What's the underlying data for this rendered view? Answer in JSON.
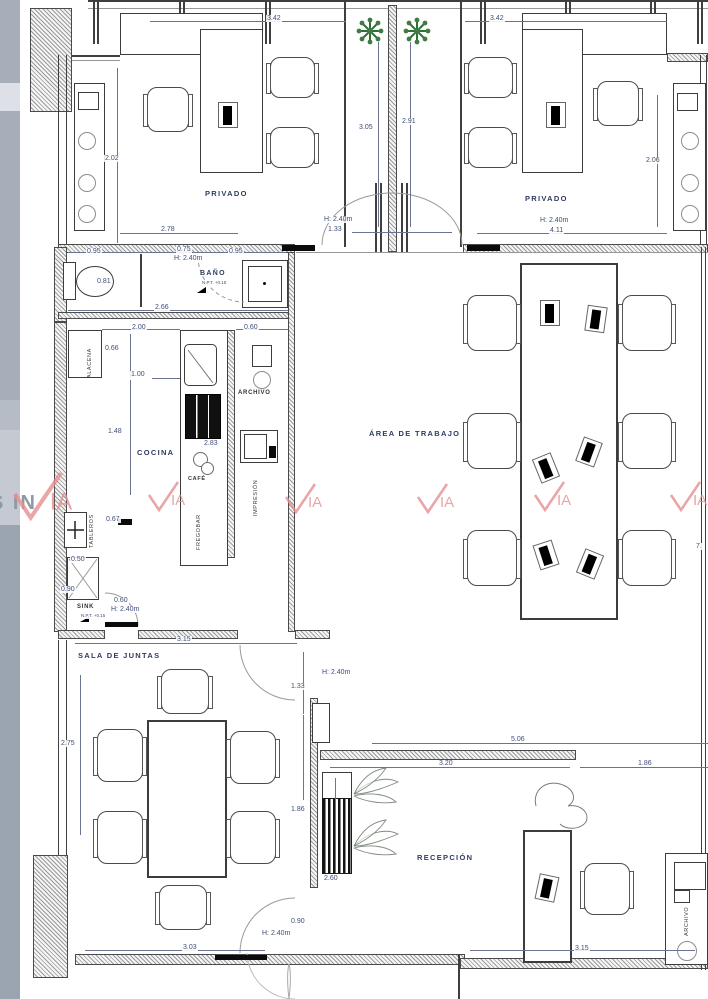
{
  "document": {
    "kind": "office floor plan",
    "units": "m"
  },
  "rooms": {
    "privado_left": "PRIVADO",
    "privado_right": "PRIVADO",
    "bano": "BAÑO",
    "cocina": "COCINA",
    "area_trabajo": "ÁREA DE TRABAJO",
    "sala_juntas": "SALA DE JUNTAS",
    "recepcion": "RECEPCIÓN"
  },
  "fixtures": {
    "alacena": "ALACENA",
    "cafe": "CAFÉ",
    "fregobar": "FREGOBAR",
    "tableros": "TABLEROS",
    "archivo_cocina": "ARCHIVO",
    "impresion": "IMPRESIÓN",
    "sink": "SINK",
    "archivo_recepcion": "ARCHIVO",
    "npt_bano": "N.P.T. +0.15",
    "npt_sink": "N.P.T. +0.15"
  },
  "dims": {
    "top_left": "3.42",
    "top_right": "3.42",
    "priv_left_side": "2.02",
    "priv_left_bottom": "2.78",
    "corridor_left": "3.05",
    "corridor_right": "2.91",
    "corridor_door_h": "H: 2.40m",
    "corridor_door_w": "1.33",
    "priv_right_side": "2.06",
    "priv_right_door_h": "H: 2.40m",
    "priv_right_bottom": "4.11",
    "bath_left": "0.95",
    "bath_mid": "0.75",
    "bath_door_h": "H: 2.40m",
    "bath_right": "0.95",
    "bath_wc": "0.81",
    "bath_width": "2.66",
    "kitchen_top": "2.00",
    "archivo_top": "0.60",
    "alacena_h": "0.66",
    "kitchen_a": "1.00",
    "kitchen_b": "1.48",
    "counter_len": "2.83",
    "tableros_w": "0.67",
    "sink_w": "0.50",
    "sink_h": "0.90",
    "sink_door_w": "0.60",
    "sink_door_h": "H: 2.40m",
    "sala_top": "3.15",
    "sala_left": "2.75",
    "sala_door_w": "1.33",
    "sala_door_h": "H: 2.40m",
    "sala_right": "1.86",
    "sala_bdoor_w": "0.90",
    "sala_bdoor_h": "H: 2.40m",
    "sala_bottom": "3.03",
    "recep_top": "5.06",
    "recep_a": "3.20",
    "recep_b": "1.86",
    "recep_left": "2.60",
    "recep_bottom": "3.15",
    "work_right": "7."
  },
  "watermark": {
    "brand": "IA",
    "side_text": "S IN",
    "color": "#e59090"
  },
  "colors": {
    "tree": "#3e7c42",
    "dim_text": "#3f4e78",
    "line": "#3f3f3f"
  }
}
